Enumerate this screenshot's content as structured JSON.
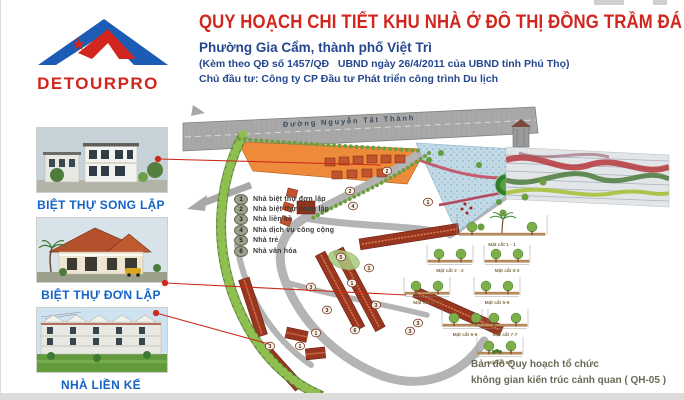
{
  "palette": {
    "title_red": "#d2251e",
    "navy": "#25478f",
    "caption_blue": "#1463c6",
    "parcel_orange": "#ef8a3a",
    "road_gray": "#a8a8a8",
    "leader_red": "#cc2a1a"
  },
  "logo": {
    "brand": "DETOURPRO"
  },
  "header": {
    "title": "QUY HOẠCH CHI TIẾT KHU NHÀ Ở ĐÔ THỊ ĐỒNG TRẦM ĐÁ",
    "subtitle": "Phường Gia Cẩm, thành phố Việt Trì",
    "decision_line": "(Kèm theo QĐ số 1457/QĐ   UBND ngày 26/4/2011 của UBND tỉnh Phú Thọ)",
    "investor_line": "Chủ đầu tư: Công ty CP Đầu tư Phát triển công trình Du lịch"
  },
  "sidebar": {
    "cards": [
      {
        "label": "BIỆT THỰ SONG LẬP"
      },
      {
        "label": "BIỆT THỰ ĐƠN LẬP"
      },
      {
        "label": "NHÀ LIỀN KẾ"
      }
    ]
  },
  "map": {
    "road_label": "Đường Nguyễn Tất Thành",
    "legend": {
      "items": [
        {
          "num": "1",
          "label": "Nhà biệt thự đơn lập"
        },
        {
          "num": "2",
          "label": "Nhà biệt thự song lập"
        },
        {
          "num": "3",
          "label": "Nhà liền kề"
        },
        {
          "num": "4",
          "label": "Nhà dịch vụ công cộng"
        },
        {
          "num": "5",
          "label": "Nhà trẻ"
        },
        {
          "num": "6",
          "label": "Nhà văn hóa"
        }
      ]
    },
    "sections": {
      "labels": [
        "Mặt cắt 1 - 1",
        "Mặt cắt 2 - 2",
        "Mặt cắt 3-3",
        "Mặt cắt 4 - 4",
        "Mặt cắt 5-5",
        "Mặt cắt 6-6",
        "Mặt cắt 7-7",
        "Mặt cắt 8-8"
      ]
    },
    "badges": [
      {
        "n": "2",
        "x": 208,
        "y": 66
      },
      {
        "n": "2",
        "x": 171,
        "y": 86
      },
      {
        "n": "4",
        "x": 174,
        "y": 101
      },
      {
        "n": "1",
        "x": 249,
        "y": 97
      },
      {
        "n": "1",
        "x": 190,
        "y": 163
      },
      {
        "n": "1",
        "x": 173,
        "y": 178
      },
      {
        "n": "3",
        "x": 132,
        "y": 182
      },
      {
        "n": "3",
        "x": 148,
        "y": 205
      },
      {
        "n": "3",
        "x": 197,
        "y": 200
      },
      {
        "n": "3",
        "x": 239,
        "y": 218
      },
      {
        "n": "3",
        "x": 231,
        "y": 226
      },
      {
        "n": "1",
        "x": 137,
        "y": 228
      },
      {
        "n": "3",
        "x": 91,
        "y": 241
      },
      {
        "n": "1",
        "x": 121,
        "y": 241
      },
      {
        "n": "5",
        "x": 162,
        "y": 152
      },
      {
        "n": "6",
        "x": 176,
        "y": 225
      }
    ],
    "caption": {
      "line1": "Bản đồ Quy hoạch tổ chức",
      "line2": "không gian kiến trúc cảnh quan ( QH-05 )"
    }
  }
}
